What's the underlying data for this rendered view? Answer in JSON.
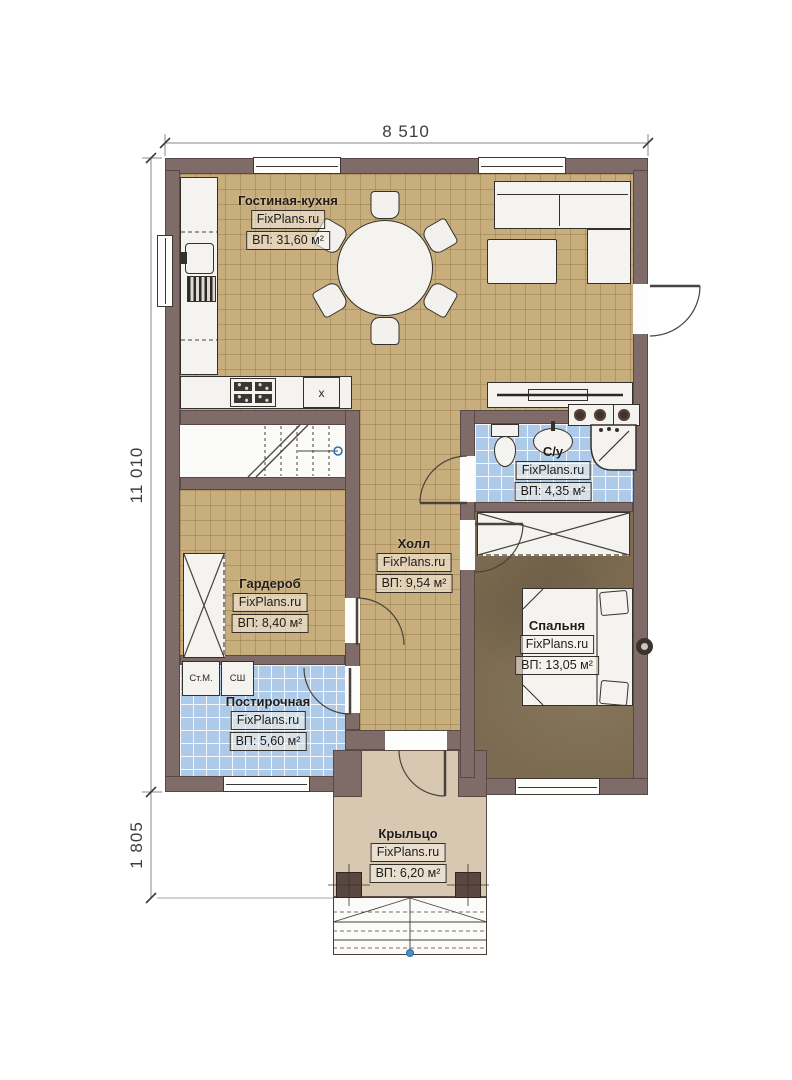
{
  "watermark": "FixPlans.ru",
  "dimensions": {
    "width_top": "8 510",
    "height_left": "11 010",
    "porch_height": "1 805"
  },
  "rooms": {
    "living": {
      "name": "Гостиная-кухня",
      "area": "ВП: 31,60 м²"
    },
    "bathroom": {
      "name": "С/у",
      "area": "ВП: 4,35 м²"
    },
    "hall": {
      "name": "Холл",
      "area": "ВП: 9,54 м²"
    },
    "wardrobe": {
      "name": "Гардероб",
      "area": "ВП: 8,40 м²"
    },
    "bedroom": {
      "name": "Спальня",
      "area": "ВП: 13,05 м²"
    },
    "laundry": {
      "name": "Постирочная",
      "area": "ВП: 5,60 м²"
    },
    "porch": {
      "name": "Крыльцо",
      "area": "ВП: 6,20 м²"
    }
  },
  "appliances": {
    "washing_machine": "Ст.М.",
    "drying_cabinet": "СШ",
    "appliance_x": "х"
  }
}
